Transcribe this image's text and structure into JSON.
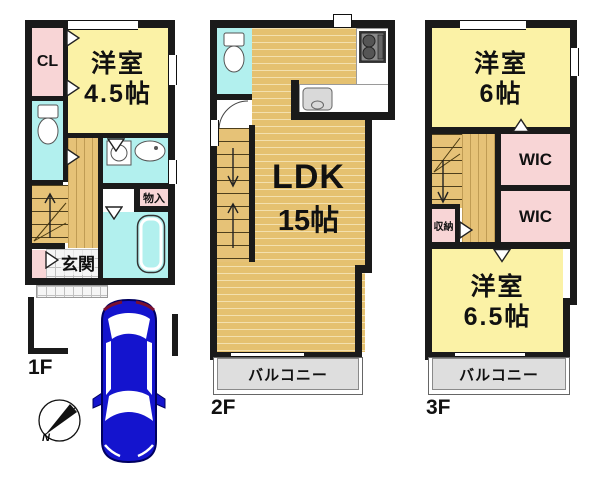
{
  "floor1": {
    "label": "1F",
    "closet": "CL",
    "room_name": "洋室",
    "room_size": "4.5帖",
    "entrance": "玄関",
    "storage": "物入"
  },
  "floor2": {
    "label": "2F",
    "ldk_name": "LDK",
    "ldk_size": "15帖",
    "balcony": "バルコニー"
  },
  "floor3": {
    "label": "3F",
    "room1_name": "洋室",
    "room1_size": "6帖",
    "wic1": "WIC",
    "wic2": "WIC",
    "storage": "収納",
    "room2_name": "洋室",
    "room2_size": "6.5帖",
    "balcony": "バルコニー"
  },
  "compass": {
    "north": "N"
  },
  "colors": {
    "wall": "#1a1a1a",
    "room_yellow": "#FBF2A6",
    "room_pink": "#F8D5D6",
    "room_cyan": "#B2F0EE",
    "floor_tan": "#E6C277",
    "balcony_gray": "#DEDEDE",
    "car_blue": "#1414CE"
  }
}
